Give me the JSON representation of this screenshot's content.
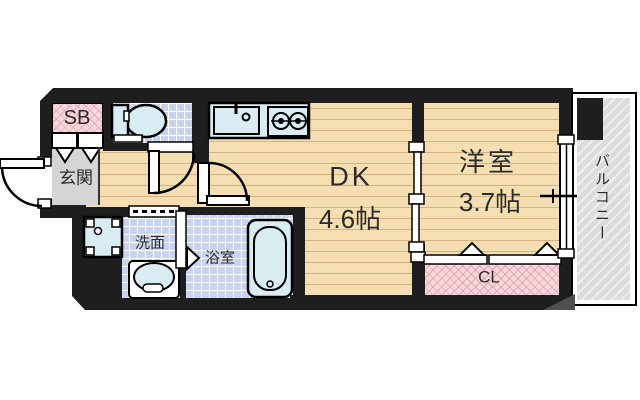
{
  "title": "1DK apartment floor plan",
  "rooms": {
    "shoe_box": "SB",
    "entrance": "玄関",
    "washroom": "洗面",
    "bathroom": "浴室",
    "dining_kitchen": "DK",
    "dining_kitchen_size": "4.6帖",
    "western_room": "洋室",
    "western_room_size": "3.7帖",
    "closet": "CL",
    "balcony": "バルコニー"
  },
  "colors": {
    "wall": "#1e1e1e",
    "wood": "#f5dfb2",
    "wood_line": "#d3b384",
    "tile": "#c9d3f0",
    "fixture": "#d9ecf2",
    "pink": "#f8d8dc",
    "pink_line": "#e5a8b2",
    "gray_floor": "#d5d5d5",
    "balcony_bg": "#dcdcdc",
    "balcony_line": "#efefef",
    "text": "#2b2b2b",
    "outside": "#ffffff"
  }
}
